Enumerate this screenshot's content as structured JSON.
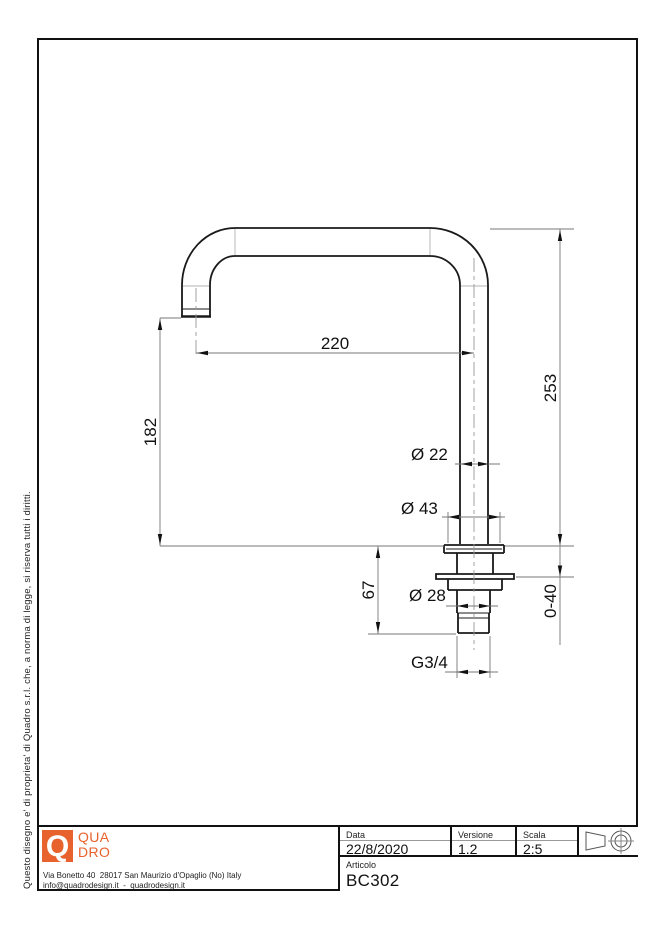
{
  "sheet": {
    "side_note": "Questo disegno e' di proprieta' di Quadro s.r.l. che, a norma di legge, si riserva tutti i diritti."
  },
  "dimensions": {
    "horizontal_reach": "220",
    "total_height": "253",
    "spout_height": "182",
    "shank_length": "67",
    "deck_range": "0-40",
    "tube_diameter": "Ø 22",
    "flange_diameter": "Ø 43",
    "shank_diameter": "Ø 28",
    "thread": "G3/4"
  },
  "title_block": {
    "data_label": "Data",
    "data_value": "22/8/2020",
    "versione_label": "Versione",
    "versione_value": "1.2",
    "scala_label": "Scala",
    "scala_value": "2:5",
    "articolo_label": "Articolo",
    "articolo_value": "BC302"
  },
  "company": {
    "logo_letter": "Q",
    "logo_word_top": "QUA",
    "logo_word_bottom": "DRO",
    "address_line1": "Via Bonetto 40  28017 San Maurizio d'Opaglio (No) Italy",
    "address_line2": "info@quadrodesign.it  -  quadrodesign.it"
  },
  "colors": {
    "accent": "#E8622D",
    "outline": "#1a1a1a",
    "dim_line": "#777777"
  }
}
